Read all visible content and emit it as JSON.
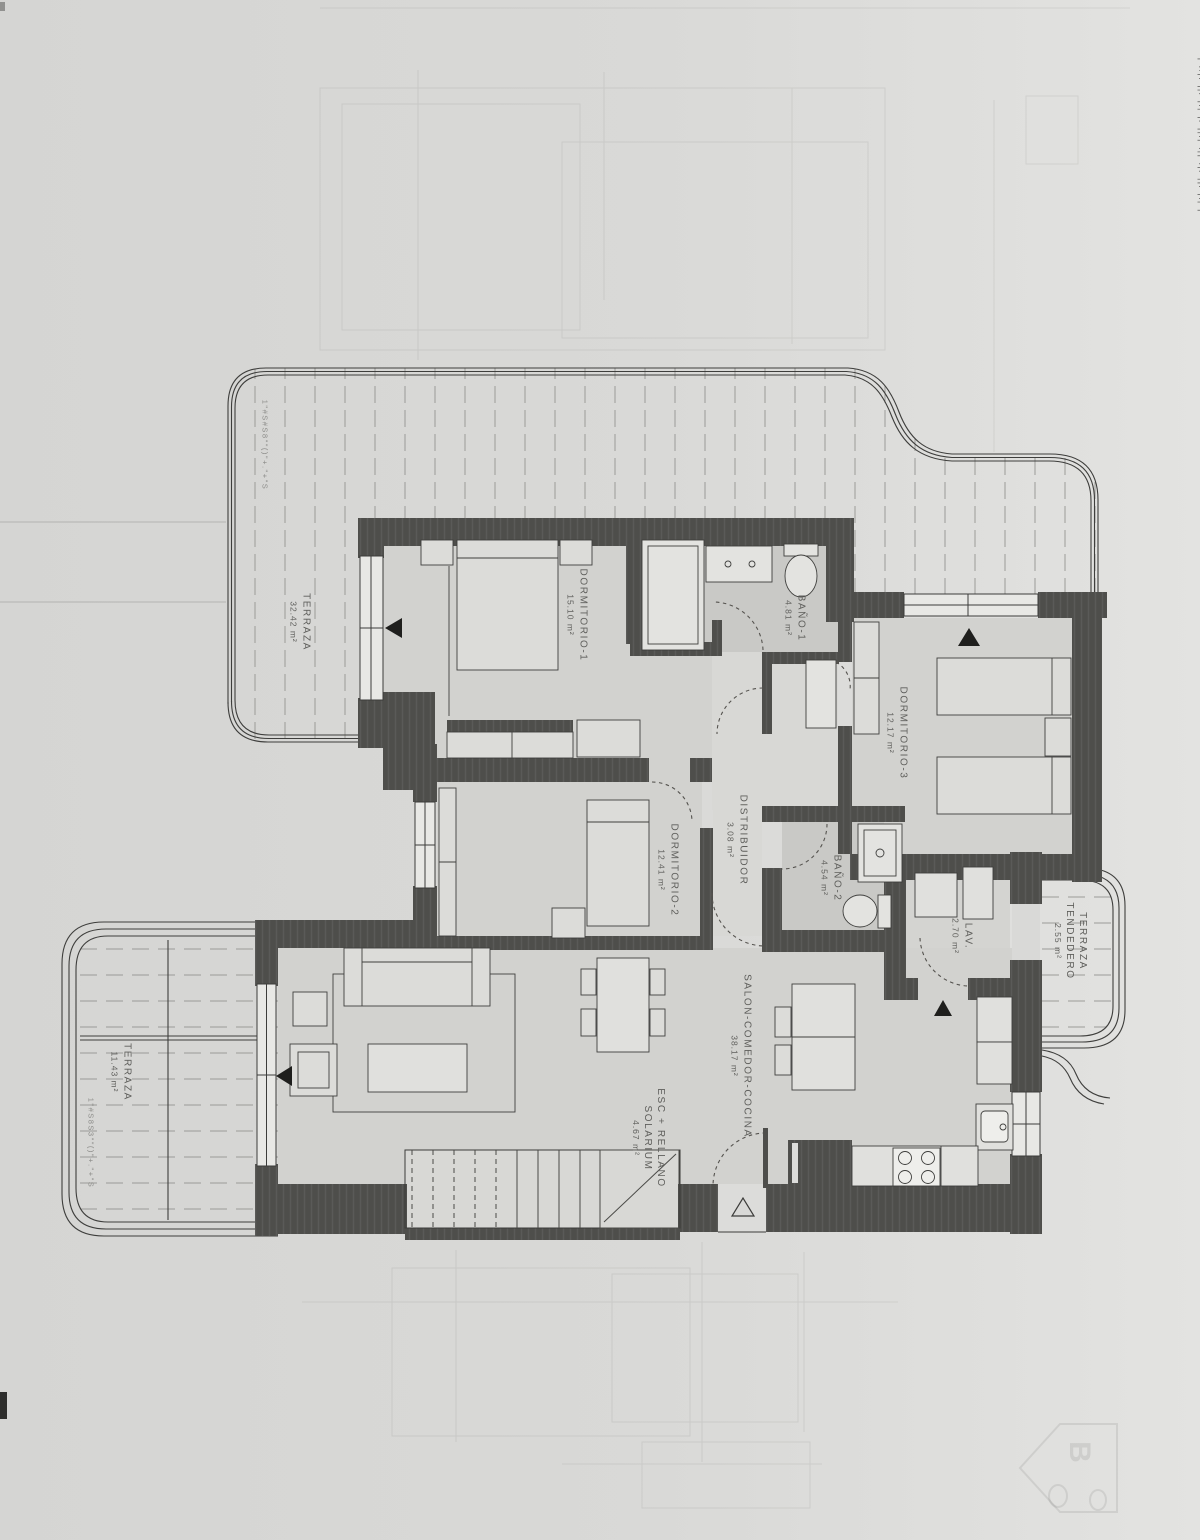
{
  "document": {
    "kind": "apartment floor plan (scanned blueprint, rotated 90°)"
  },
  "rooms": [
    {
      "id": "terraza-main",
      "name": "TERRAZA",
      "area": "32.42 m²"
    },
    {
      "id": "dormitorio-1",
      "name": "DORMITORIO-1",
      "area": "15.10 m²"
    },
    {
      "id": "bano-1",
      "name": "BAÑO-1",
      "area": "4.81 m²"
    },
    {
      "id": "dormitorio-3",
      "name": "DORMITORIO-3",
      "area": "12.17 m²"
    },
    {
      "id": "distribuidor",
      "name": "DISTRIBUIDOR",
      "area": "3.08 m²"
    },
    {
      "id": "bano-2",
      "name": "BAÑO-2",
      "area": "4.54 m²"
    },
    {
      "id": "lavadero",
      "name": "LAV.",
      "area": "2.70 m²"
    },
    {
      "id": "terraza-tendedero",
      "name": "TERRAZA",
      "name2": "TENDEDERO",
      "area": "2.55 m²"
    },
    {
      "id": "dormitorio-2",
      "name": "DORMITORIO-2",
      "area": "12.41 m²"
    },
    {
      "id": "salon",
      "name": "SALON-COMEDOR-COCINA",
      "area": "38.17 m²"
    },
    {
      "id": "escalera",
      "name": "ESC + RELLANO",
      "name2": "SOLARIUM",
      "area": "4.67 m²"
    },
    {
      "id": "terraza-lower",
      "name": "TERRAZA",
      "area": "11.43 m²"
    }
  ],
  "annotations": {
    "edge_note_top": "1\"#S#S8\"\"()\"+.\"+\"S",
    "edge_note_bottom": "1\"#S8S3\"\"()\"+.\"+\"S",
    "right_edge_strip": "¦·l!¦i·¦|l·¦i|·¦l·¦|i¦·l|¦·i¦l·|¦i·¦l|·¦",
    "watermark_letter": "B"
  },
  "colors": {
    "paper": "#d9d9d7",
    "wall": "#4e4e4b",
    "floor": "#d2d2cf",
    "bath_floor": "#c9c9c6",
    "line": "#3c3c3a"
  }
}
